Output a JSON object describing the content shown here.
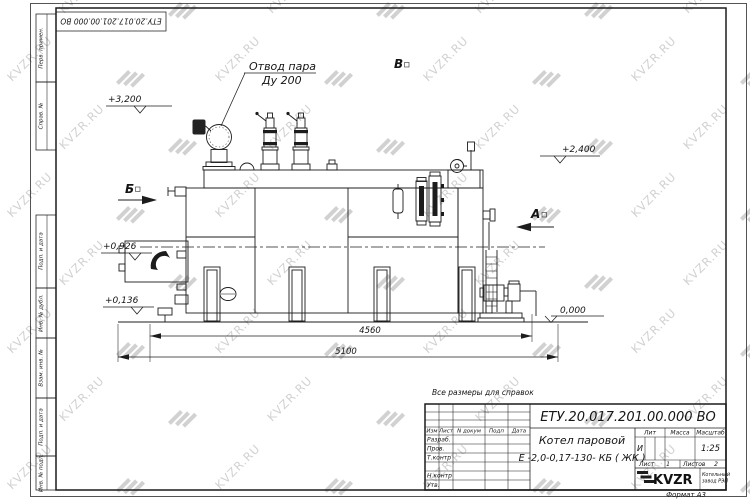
{
  "watermark": {
    "text": "KVZR.RU",
    "color": "#c9c9c9"
  },
  "corner_stamp": {
    "designation": "ЕТУ.20.017.201.00.000 ВО"
  },
  "side_stamp": {
    "labels": [
      "Перв. примен.",
      "Справ. №",
      "Подп. и дата",
      "Инв. № дубл.",
      "Взам. инв. №",
      "Подп. и дата",
      "Инв. № подл."
    ]
  },
  "drawing": {
    "callout": {
      "line1": "Отвод пара",
      "line2": "Ду 200"
    },
    "elevations": {
      "top": "+3,200",
      "right_upper": "+2,400",
      "left_mid": "+0,926",
      "left_low": "+0,136",
      "ground": "0,000"
    },
    "sections": {
      "b": "Б",
      "v": "В",
      "a": "А"
    },
    "dimensions": {
      "inner": "4560",
      "overall": "5100"
    },
    "note": "Все размеры для справок"
  },
  "title_block": {
    "designation": "ЕТУ.20.017.201.00.000 ВО",
    "product_name_line1": "Котел паровой",
    "product_name_line2": "Е -2,0-0,17-130- КБ ( ЖК )",
    "columns": {
      "izm": "Изм",
      "list": "Лист",
      "doc": "N докум",
      "sign": "Подп",
      "date": "Дата"
    },
    "rows": {
      "developed": "Разраб.",
      "checked": "Пров.",
      "tcontrol": "Т.контр",
      "ncontrol": "Н.контр",
      "approved": "Утв."
    },
    "lit": {
      "label": "Лит",
      "value": "И"
    },
    "mass": {
      "label": "Масса"
    },
    "scale": {
      "label": "Масштаб",
      "value": "1:25"
    },
    "sheet": {
      "label": "Лист",
      "value": "1"
    },
    "sheets": {
      "label": "Листов",
      "value": "2"
    },
    "logo": {
      "text": "KVZR",
      "sub1": "Котельный",
      "sub2": "завод РЭП"
    },
    "format": "Формат А3"
  }
}
